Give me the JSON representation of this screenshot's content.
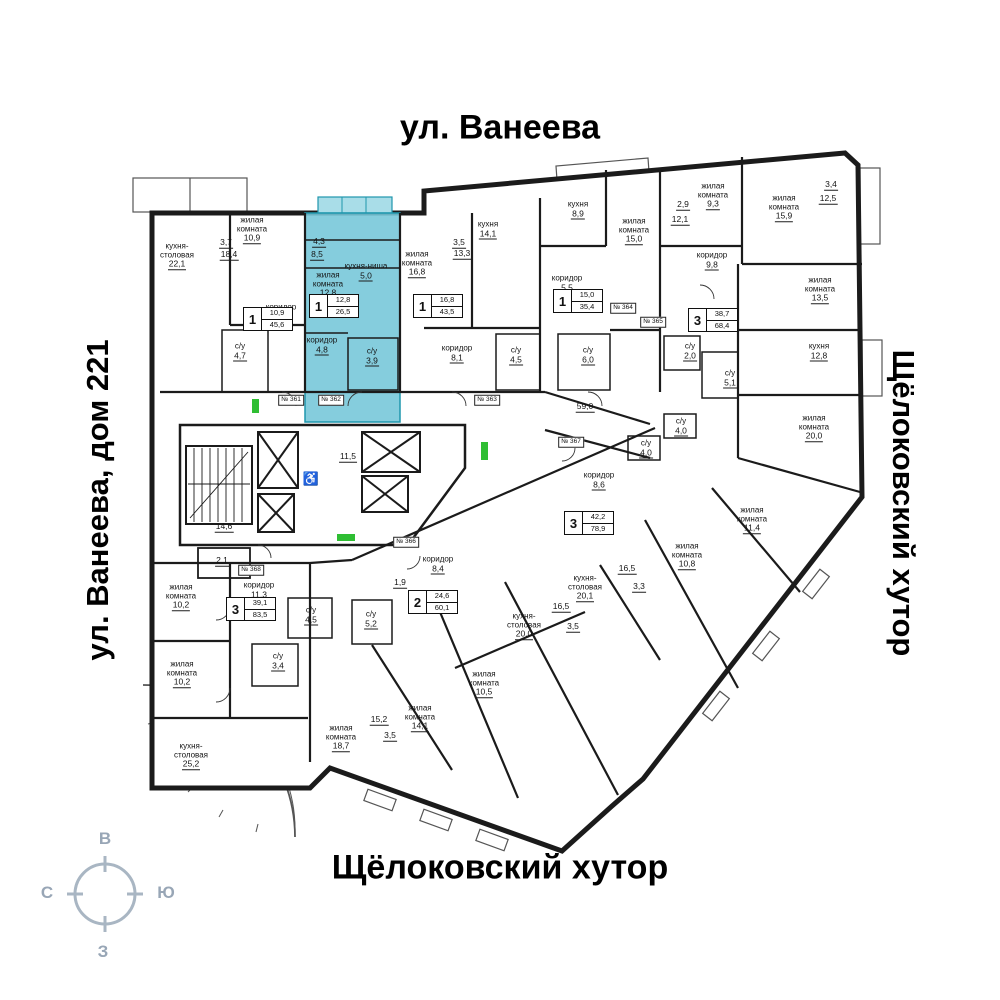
{
  "titles": {
    "top": "ул. Ванеева",
    "left": "ул. Ванеева, дом 221",
    "right": "Щёлоковский хутор",
    "bottom": "Щёлоковский хутор"
  },
  "compass": {
    "top": "В",
    "left": "С",
    "right": "Ю",
    "bottom": "З"
  },
  "colors": {
    "highlight_fill": "#74c6d8",
    "highlight_stroke": "#1f97ad",
    "wall": "#1b1b1b",
    "green_marker": "#2fbe33",
    "compass_gray": "#98a6b6"
  },
  "highlighted_apartment": {
    "rooms_count": "1",
    "living_area": "12,8",
    "total_area": "26,5",
    "number_tag": "№ 362"
  },
  "rooms": [
    {
      "name": "кухня-\nстоловая",
      "area": "22,1",
      "x": 177,
      "y": 256
    },
    {
      "name": "жилая\nкомната",
      "area": "10,9",
      "x": 252,
      "y": 230
    },
    {
      "name": "",
      "area": "3,7",
      "x": 226,
      "y": 243
    },
    {
      "name": "",
      "area": "18,4",
      "x": 229,
      "y": 255
    },
    {
      "name": "коридор",
      "area": "7,9",
      "x": 281,
      "y": 313
    },
    {
      "name": "с/у",
      "area": "4,7",
      "x": 240,
      "y": 352
    },
    {
      "name": "",
      "area": "4,3",
      "x": 319,
      "y": 242
    },
    {
      "name": "",
      "area": "8,5",
      "x": 317,
      "y": 255
    },
    {
      "name": "жилая\nкомната",
      "area": "12,8",
      "x": 328,
      "y": 285
    },
    {
      "name": "кухня-ниша",
      "area": "5,0",
      "x": 366,
      "y": 272
    },
    {
      "name": "коридор",
      "area": "4,8",
      "x": 322,
      "y": 346
    },
    {
      "name": "с/у",
      "area": "3,9",
      "x": 372,
      "y": 357
    },
    {
      "name": "жилая\nкомната",
      "area": "16,8",
      "x": 417,
      "y": 264
    },
    {
      "name": "",
      "area": "3,5",
      "x": 459,
      "y": 243
    },
    {
      "name": "",
      "area": "13,3",
      "x": 462,
      "y": 254
    },
    {
      "name": "кухня",
      "area": "14,1",
      "x": 488,
      "y": 230
    },
    {
      "name": "коридор",
      "area": "8,1",
      "x": 457,
      "y": 354
    },
    {
      "name": "с/у",
      "area": "4,5",
      "x": 516,
      "y": 356
    },
    {
      "name": "кухня",
      "area": "8,9",
      "x": 578,
      "y": 210
    },
    {
      "name": "жилая\nкомната",
      "area": "15,0",
      "x": 634,
      "y": 231
    },
    {
      "name": "",
      "area": "2,9",
      "x": 683,
      "y": 205
    },
    {
      "name": "",
      "area": "12,1",
      "x": 680,
      "y": 220
    },
    {
      "name": "коридор",
      "area": "5,5",
      "x": 567,
      "y": 284
    },
    {
      "name": "с/у",
      "area": "6,0",
      "x": 588,
      "y": 356
    },
    {
      "name": "жилая\nкомната",
      "area": "9,3",
      "x": 713,
      "y": 196
    },
    {
      "name": "жилая\nкомната",
      "area": "15,9",
      "x": 784,
      "y": 208
    },
    {
      "name": "",
      "area": "3,4",
      "x": 831,
      "y": 185
    },
    {
      "name": "",
      "area": "12,5",
      "x": 828,
      "y": 199
    },
    {
      "name": "коридор",
      "area": "9,8",
      "x": 712,
      "y": 261
    },
    {
      "name": "жилая\nкомната",
      "area": "13,5",
      "x": 820,
      "y": 290
    },
    {
      "name": "с/у",
      "area": "2,0",
      "x": 690,
      "y": 352
    },
    {
      "name": "с/у",
      "area": "5,1",
      "x": 730,
      "y": 379
    },
    {
      "name": "кухня",
      "area": "12,8",
      "x": 819,
      "y": 352
    },
    {
      "name": "жилая\nкомната",
      "area": "20,0",
      "x": 814,
      "y": 428
    },
    {
      "name": "",
      "area": "59,0",
      "x": 585,
      "y": 407
    },
    {
      "name": "",
      "area": "11,5",
      "x": 348,
      "y": 457
    },
    {
      "name": "",
      "area": "14,6",
      "x": 224,
      "y": 527
    },
    {
      "name": "",
      "area": "2,1",
      "x": 222,
      "y": 561
    },
    {
      "name": "с/у",
      "area": "4,0",
      "x": 681,
      "y": 427
    },
    {
      "name": "с/у",
      "area": "4,0",
      "x": 646,
      "y": 449
    },
    {
      "name": "коридор",
      "area": "8,6",
      "x": 599,
      "y": 481
    },
    {
      "name": "жилая\nкомната",
      "area": "11,4",
      "x": 752,
      "y": 520
    },
    {
      "name": "жилая\nкомната",
      "area": "10,8",
      "x": 687,
      "y": 556
    },
    {
      "name": "",
      "area": "16,5",
      "x": 627,
      "y": 569
    },
    {
      "name": "",
      "area": "3,3",
      "x": 639,
      "y": 587
    },
    {
      "name": "кухня-\nстоловая",
      "area": "20,1",
      "x": 585,
      "y": 588
    },
    {
      "name": "коридор",
      "area": "8,4",
      "x": 438,
      "y": 565
    },
    {
      "name": "",
      "area": "1,9",
      "x": 400,
      "y": 583
    },
    {
      "name": "с/у",
      "area": "5,2",
      "x": 371,
      "y": 620
    },
    {
      "name": "с/у",
      "area": "4,5",
      "x": 311,
      "y": 616
    },
    {
      "name": "кухня-\nстоловая",
      "area": "20,0",
      "x": 524,
      "y": 626
    },
    {
      "name": "",
      "area": "16,5",
      "x": 561,
      "y": 607
    },
    {
      "name": "",
      "area": "3,5",
      "x": 573,
      "y": 627
    },
    {
      "name": "жилая\nкомната",
      "area": "10,5",
      "x": 484,
      "y": 684
    },
    {
      "name": "жилая\nкомната",
      "area": "14,1",
      "x": 420,
      "y": 718
    },
    {
      "name": "",
      "area": "15,2",
      "x": 379,
      "y": 720
    },
    {
      "name": "",
      "area": "3,5",
      "x": 390,
      "y": 736
    },
    {
      "name": "жилая\nкомната",
      "area": "18,7",
      "x": 341,
      "y": 738
    },
    {
      "name": "жилая\nкомната",
      "area": "10,2",
      "x": 181,
      "y": 597
    },
    {
      "name": "жилая\nкомната",
      "area": "10,2",
      "x": 182,
      "y": 674
    },
    {
      "name": "кухня-\nстоловая",
      "area": "25,2",
      "x": 191,
      "y": 756
    },
    {
      "name": "коридор",
      "area": "11,3",
      "x": 259,
      "y": 591
    },
    {
      "name": "с/у",
      "area": "3,4",
      "x": 278,
      "y": 662
    }
  ],
  "badges": [
    {
      "rooms": "1",
      "living": "10,9",
      "total": "45,6",
      "x": 268,
      "y": 319
    },
    {
      "rooms": "1",
      "living": "12,8",
      "total": "26,5",
      "x": 334,
      "y": 306
    },
    {
      "rooms": "1",
      "living": "16,8",
      "total": "43,5",
      "x": 438,
      "y": 306
    },
    {
      "rooms": "1",
      "living": "15,0",
      "total": "35,4",
      "x": 578,
      "y": 301
    },
    {
      "rooms": "3",
      "living": "38,7",
      "total": "68,4",
      "x": 713,
      "y": 320
    },
    {
      "rooms": "3",
      "living": "42,2",
      "total": "78,9",
      "x": 589,
      "y": 523
    },
    {
      "rooms": "2",
      "living": "24,6",
      "total": "60,1",
      "x": 433,
      "y": 602
    },
    {
      "rooms": "3",
      "living": "39,1",
      "total": "83,5",
      "x": 251,
      "y": 609
    }
  ],
  "tags": [
    {
      "label": "№ 361",
      "x": 291,
      "y": 400
    },
    {
      "label": "№ 362",
      "x": 331,
      "y": 400
    },
    {
      "label": "№ 363",
      "x": 487,
      "y": 400
    },
    {
      "label": "№ 364",
      "x": 623,
      "y": 308
    },
    {
      "label": "№ 365",
      "x": 653,
      "y": 322
    },
    {
      "label": "№ 366",
      "x": 406,
      "y": 542
    },
    {
      "label": "№ 367",
      "x": 571,
      "y": 442
    },
    {
      "label": "№ 368",
      "x": 251,
      "y": 570
    }
  ],
  "icons": {
    "wheelchair": "♿"
  }
}
